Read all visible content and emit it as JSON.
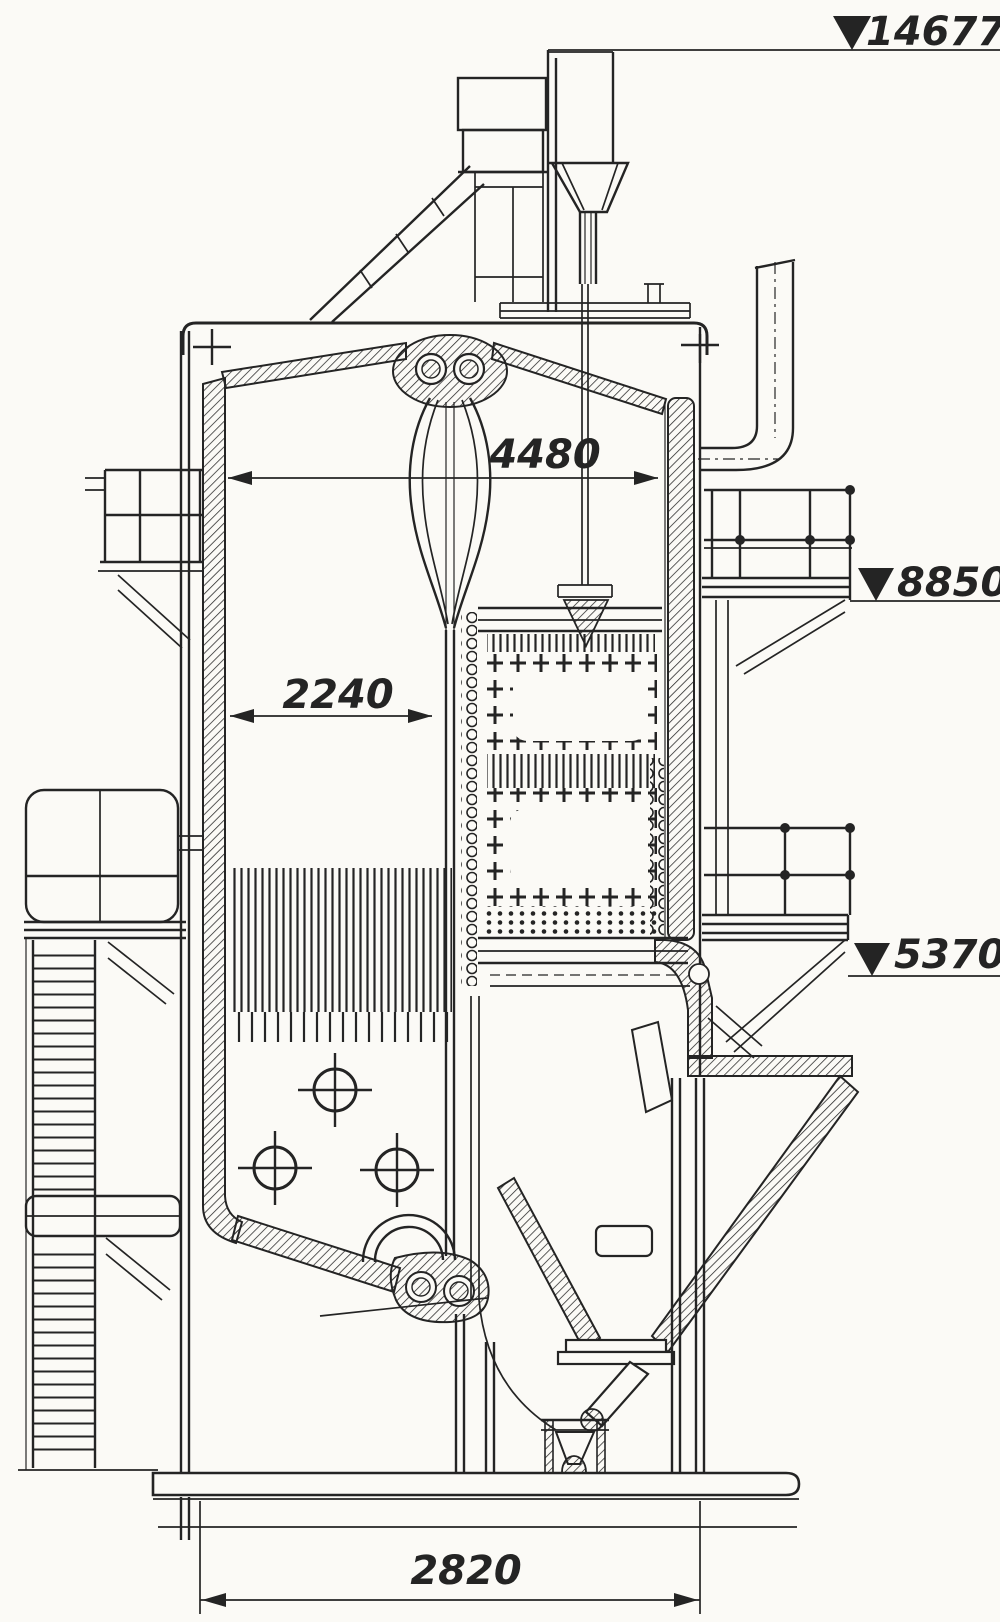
{
  "labels": {
    "elevation_top": "14677",
    "elevation_mid": "8850",
    "elevation_low": "5370",
    "dim_drum_width": "4480",
    "dim_furnace_width": "2240",
    "dim_base_width": "2820"
  },
  "colors": {
    "ink": "#242424",
    "paper": "#fbfaf6"
  }
}
